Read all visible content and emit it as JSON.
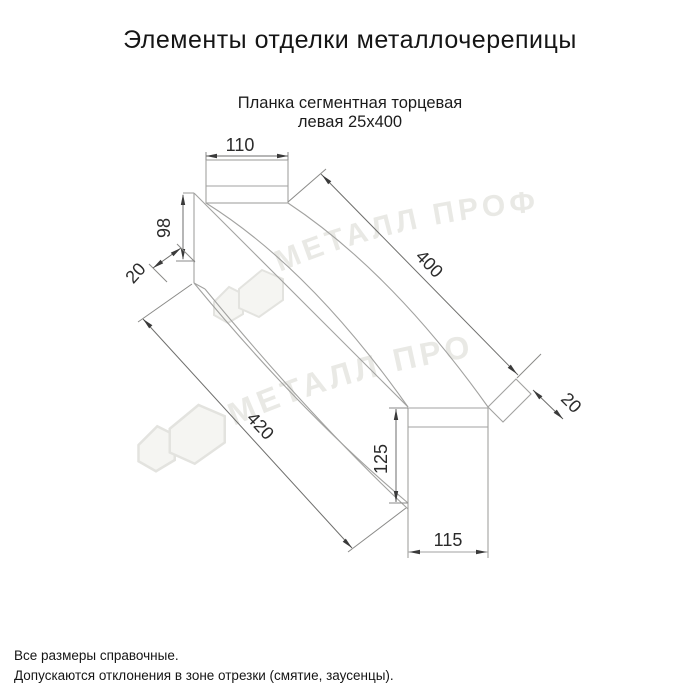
{
  "page": {
    "title": "Элементы отделки металлочерепицы"
  },
  "product": {
    "subtitle_line1": "Планка сегментная торцевая",
    "subtitle_line2": "левая 25х400"
  },
  "dimensions": {
    "top_width": "110",
    "left_height": "98",
    "left_flange": "20",
    "length_top": "400",
    "length_bottom": "420",
    "right_height": "125",
    "right_width": "115",
    "right_flange": "20"
  },
  "watermark": {
    "text": "МЕТАЛЛ ПРОФИЛЬ"
  },
  "notes": {
    "line1": "Все размеры справочные.",
    "line2": "Допускаются отклонения в зоне отрезки (смятие, заусенцы)."
  },
  "colors": {
    "drawing_line": "#a2a2a0",
    "dimension_line": "#6e6e6c",
    "dimension_text": "#2b2b2b",
    "watermark": "#e9e9e5",
    "text": "#151515"
  }
}
